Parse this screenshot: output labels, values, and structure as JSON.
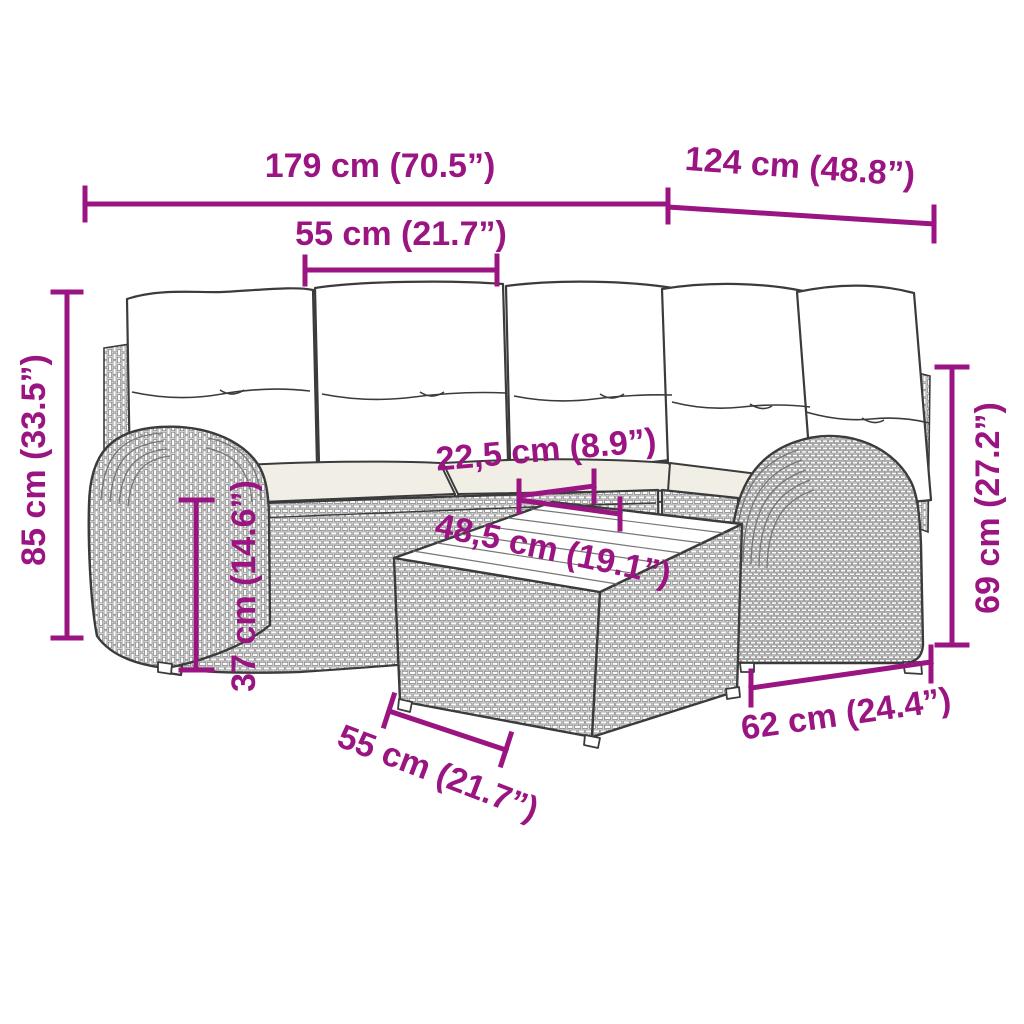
{
  "diagram": {
    "accent_color": "#9A1581",
    "line_color": "#3b3b3b",
    "texture_color": "#8a8a8a",
    "cushion_color": "#f1efe5",
    "subject": "5-piece poly rattan garden lounge set with cushions and table, line drawing with measurements"
  },
  "dimensions": [
    {
      "id": "sofa-total-width",
      "label": "179 cm (70.5”)"
    },
    {
      "id": "right-section-depth",
      "label": "124 cm (48.8”)"
    },
    {
      "id": "seat-width-top",
      "label": "55 cm (21.7”)"
    },
    {
      "id": "overall-height",
      "label": "85 cm (33.5”)"
    },
    {
      "id": "armrest-height",
      "label": "69 cm (27.2”)"
    },
    {
      "id": "table-rim-width",
      "label": "22,5 cm (8.9”)"
    },
    {
      "id": "table-top-length",
      "label": "48,5 cm (19.1”)"
    },
    {
      "id": "seat-height",
      "label": "37 cm (14.6”)"
    },
    {
      "id": "table-width-bottom",
      "label": "55 cm (21.7”)"
    },
    {
      "id": "table-depth",
      "label": "62 cm (24.4”)"
    }
  ]
}
